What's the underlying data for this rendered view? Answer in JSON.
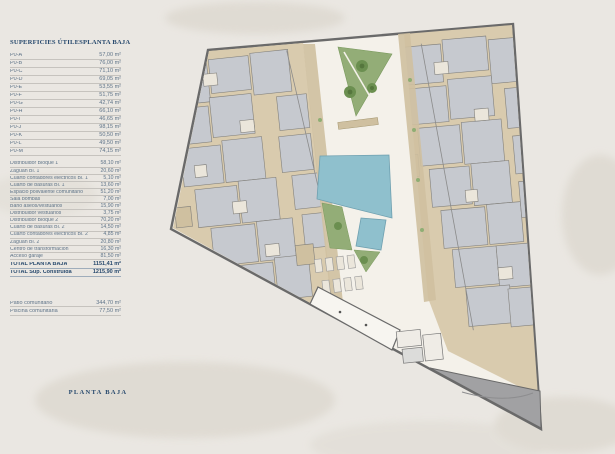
{
  "table": {
    "header_left": "SUPERFICIES ÚTILES",
    "header_right": "PLANTA BAJA",
    "units": [
      {
        "label": "P0-A",
        "value": "57,00 m²"
      },
      {
        "label": "P0-B",
        "value": "76,00 m²"
      },
      {
        "label": "P0-C",
        "value": "71,10 m²"
      },
      {
        "label": "P0-D",
        "value": "69,05 m²"
      },
      {
        "label": "P0-E",
        "value": "53,55 m²"
      },
      {
        "label": "P0-F",
        "value": "51,75 m²"
      },
      {
        "label": "P0-G",
        "value": "42,74 m²"
      },
      {
        "label": "P0-H",
        "value": "66,10 m²"
      },
      {
        "label": "P0-I",
        "value": "46,65 m²"
      },
      {
        "label": "P0-J",
        "value": "98,15 m²"
      },
      {
        "label": "P0-K",
        "value": "50,50 m²"
      },
      {
        "label": "P0-L",
        "value": "49,50 m²"
      },
      {
        "label": "P0-M",
        "value": "74,15 m²"
      }
    ],
    "common": [
      {
        "label": "Distribuidor Bloque 1",
        "value": "58,10 m²"
      },
      {
        "label": "Zaguán Bl. 1",
        "value": "20,60 m²"
      },
      {
        "label": "Cuarto contadores eléctricos Bl. 1",
        "value": "5,10 m²"
      },
      {
        "label": "Cuarto de basuras Bl. 1",
        "value": "13,60 m²"
      },
      {
        "label": "Espacio polivalente comunitario",
        "value": "51,20 m²"
      },
      {
        "label": "Sala bombas",
        "value": "7,00 m²"
      },
      {
        "label": "Baño aseos/vestuarios",
        "value": "15,90 m²"
      },
      {
        "label": "Distribuidor vestuarios",
        "value": "3,75 m²"
      },
      {
        "label": "Distribuidor Bloque 2",
        "value": "70,20 m²"
      },
      {
        "label": "Cuarto de basuras Bl. 2",
        "value": "14,50 m²"
      },
      {
        "label": "Cuarto contadores eléctricos Bl. 2",
        "value": "4,85 m²"
      },
      {
        "label": "Zaguán Bl. 2",
        "value": "20,80 m²"
      },
      {
        "label": "Centro de transformación",
        "value": "16,30 m²"
      },
      {
        "label": "Acceso garaje",
        "value": "81,50 m²"
      }
    ],
    "totals": [
      {
        "label": "TOTAL PLANTA BAJA",
        "value": "1151,41 m²"
      },
      {
        "label": "TOTAL Sup. Construida",
        "value": "1215,90 m²"
      }
    ],
    "outdoor": [
      {
        "label": "Patio comunitario",
        "value": "344,70 m²"
      },
      {
        "label": "Piscina comunitaria",
        "value": "77,50 m²"
      }
    ]
  },
  "footer": {
    "label": "PLANTA BAJA"
  },
  "palette": {
    "background": "#eae7e2",
    "accent_navy": "#27496d",
    "table_text": "#5f7489",
    "wall_gray": "#6a6a6a",
    "building_tan": "#d9cbae",
    "room_gray": "#c6c9cf",
    "garden_green": "#93ad77",
    "pool_blue": "#8fc0cd",
    "ramp_gray": "#a1a1a3"
  }
}
